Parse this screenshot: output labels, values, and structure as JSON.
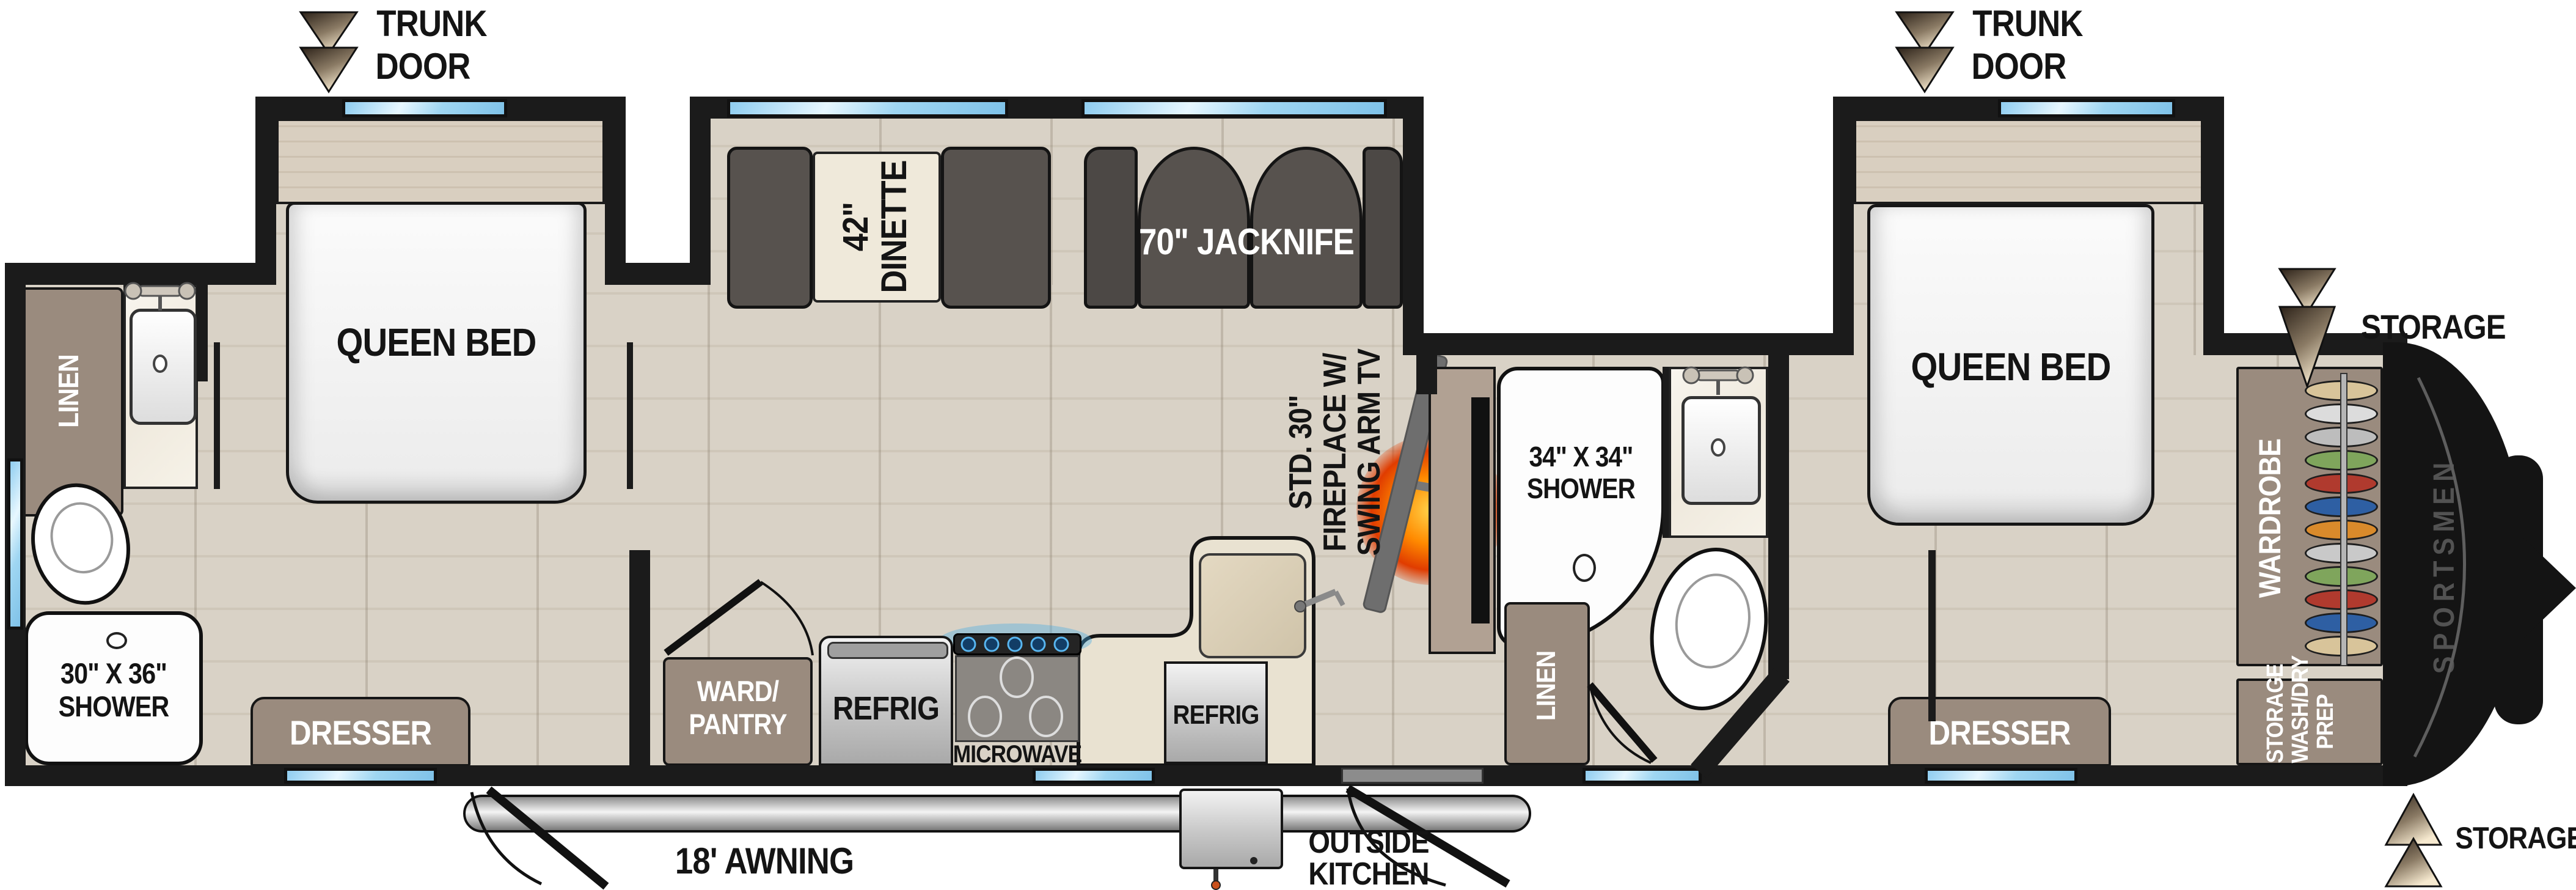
{
  "rear_trunk_door": {
    "l1": "TRUNK",
    "l2": "DOOR"
  },
  "front_trunk_door": {
    "l1": "TRUNK",
    "l2": "DOOR"
  },
  "rear_bedroom": {
    "bed": "QUEEN BED",
    "dresser": "DRESSER"
  },
  "rear_bath": {
    "linen": "LINEN",
    "shower_l1": "30\" X 36\"",
    "shower_l2": "SHOWER"
  },
  "dinette": {
    "l1": "42\"",
    "l2": "DINETTE"
  },
  "living": {
    "sofa": "70\" JACKNIFE",
    "fp_l1": "STD. 30\"",
    "fp_l2": "FIREPLACE W/",
    "fp_l3": "SWING ARM TV"
  },
  "kitchen": {
    "pantry_l1": "WARD/",
    "pantry_l2": "PANTRY",
    "refrig": "REFRIG",
    "microwave": "MICROWAVE"
  },
  "outside_kitchen": {
    "refrig": "REFRIG",
    "l1": "OUTSIDE",
    "l2": "KITCHEN"
  },
  "mid_bath": {
    "linen": "LINEN",
    "shower_l1": "34\" X 34\"",
    "shower_l2": "SHOWER"
  },
  "front_bedroom": {
    "bed": "QUEEN BED",
    "dresser": "DRESSER"
  },
  "front_storage": {
    "wardrobe": "WARDROBE",
    "washdry_l1": "STORAGE",
    "washdry_l2": "WASH/DRY",
    "washdry_l3": "PREP"
  },
  "exterior": {
    "awning": "18' AWNING",
    "storage_top": "STORAGE",
    "storage_bottom": "STORAGE",
    "brand": "SPORTSMEN"
  },
  "wardrobe_clothes": [
    "#d8c49a",
    "#dcdcdc",
    "#bdbdbd",
    "#7fa55c",
    "#b03a2e",
    "#2e5fa3",
    "#d98a2b",
    "#c9c9c9",
    "#7fa55c",
    "#b03a2e",
    "#2e5fa3",
    "#d8c49a"
  ],
  "colors": {
    "wall": "#1b1b1b",
    "floor": "#d7cfc2",
    "cabinet": "#9a8b7e",
    "sofa": "#57524e",
    "window": "#9fd4ef",
    "flame_outer": "#e03c00",
    "flame_inner": "#ffd24a",
    "counter": "#e9e2d1",
    "cap": "#141414"
  }
}
